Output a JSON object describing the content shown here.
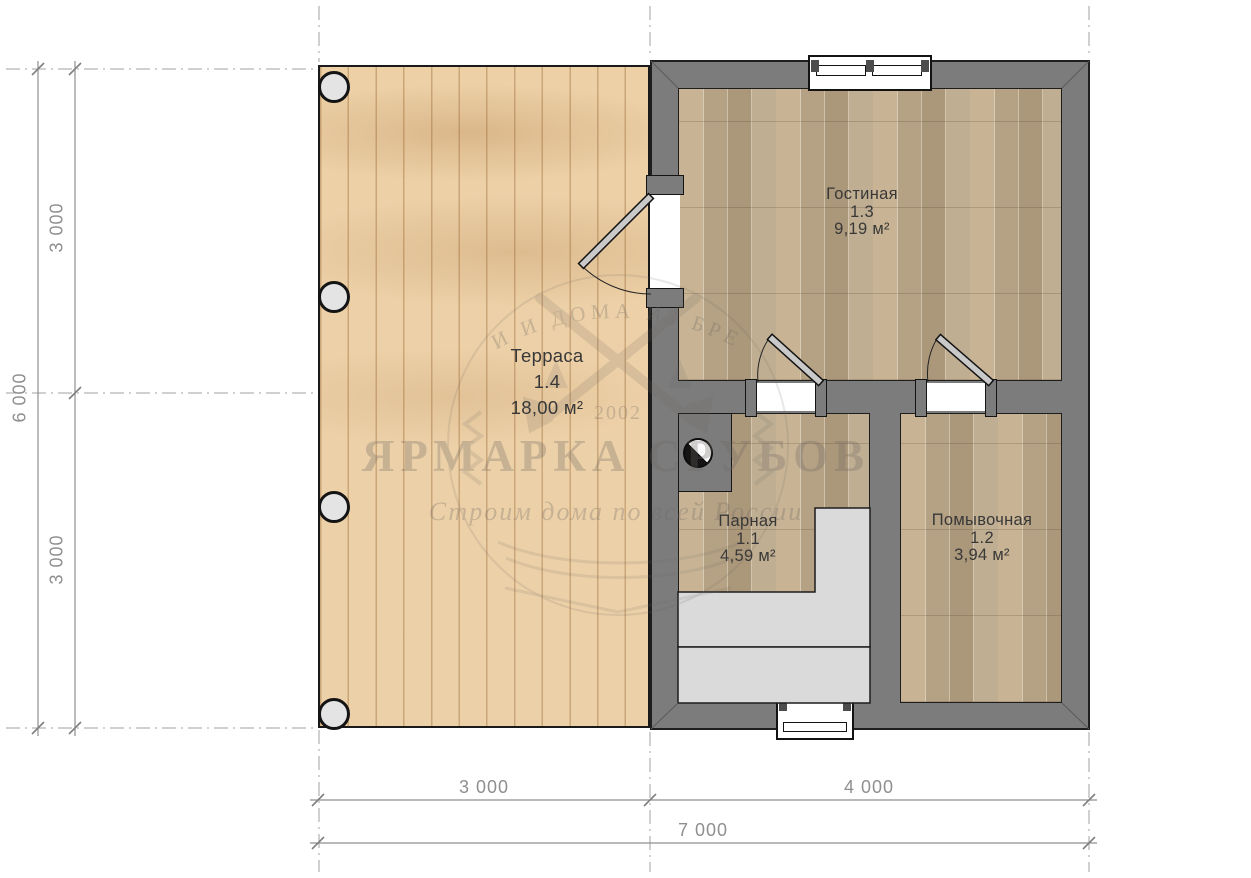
{
  "drawing": {
    "rooms": {
      "terrace": {
        "name": "Терраса",
        "number": "1.4",
        "area": "18,00 м²"
      },
      "living": {
        "name": "Гостиная",
        "number": "1.3",
        "area": "9,19 м²"
      },
      "steam": {
        "name": "Парная",
        "number": "1.1",
        "area": "4,59 м²"
      },
      "washing": {
        "name": "Помывочная",
        "number": "1.2",
        "area": "3,94 м²"
      }
    },
    "dimensions": {
      "bottom_left": "3 000",
      "bottom_right": "4 000",
      "bottom_total": "7 000",
      "left_top": "3 000",
      "left_bottom": "3 000",
      "left_total": "6 000"
    },
    "watermark": {
      "arc_text": "БАНИ И ДОМА ИЗ БРЕВНА",
      "year": "2002",
      "title": "ЯРМАРКА СРУБОВ",
      "slogan": "Строим дома по всей России"
    },
    "colors": {
      "wall": "#7c7c7c",
      "terrace_wood": "#ecd0a8",
      "parquet": "#c3b093",
      "bench": "#dadada",
      "dimension_gray": "#8f8f8f",
      "label_dark": "#383838"
    }
  }
}
